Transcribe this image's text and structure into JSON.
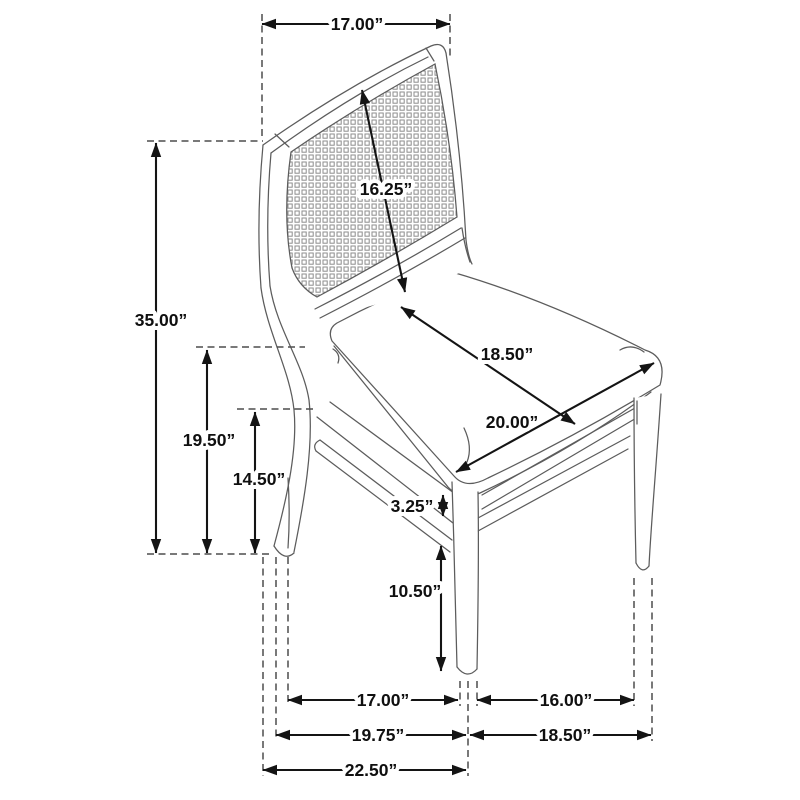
{
  "figure": {
    "kind": "product-dimension-diagram",
    "subject": "dining side chair with cane back, three-quarter line drawing",
    "units_suffix": "”"
  },
  "colors": {
    "background": "#ffffff",
    "dimension_lines": "#141414",
    "extension_dashes": "#4d4d4d",
    "drawing_lines": "#5c5c5c"
  },
  "labels": {
    "back_top_width": "17.00”",
    "back_panel_diagonal": "16.25”",
    "overall_height": "35.00”",
    "seat_height": "19.50”",
    "side_stretcher_height": "14.50”",
    "seat_depth": "18.50”",
    "seat_width": "20.00”",
    "seat_rail_thickness": "3.25”",
    "front_leg_height": "10.50”",
    "front_to_back_leg_span": "17.00”",
    "side_leg_span": "16.00”",
    "base_depth_rear": "19.75”",
    "base_span_right": "18.50”",
    "overall_depth": "22.50”"
  }
}
